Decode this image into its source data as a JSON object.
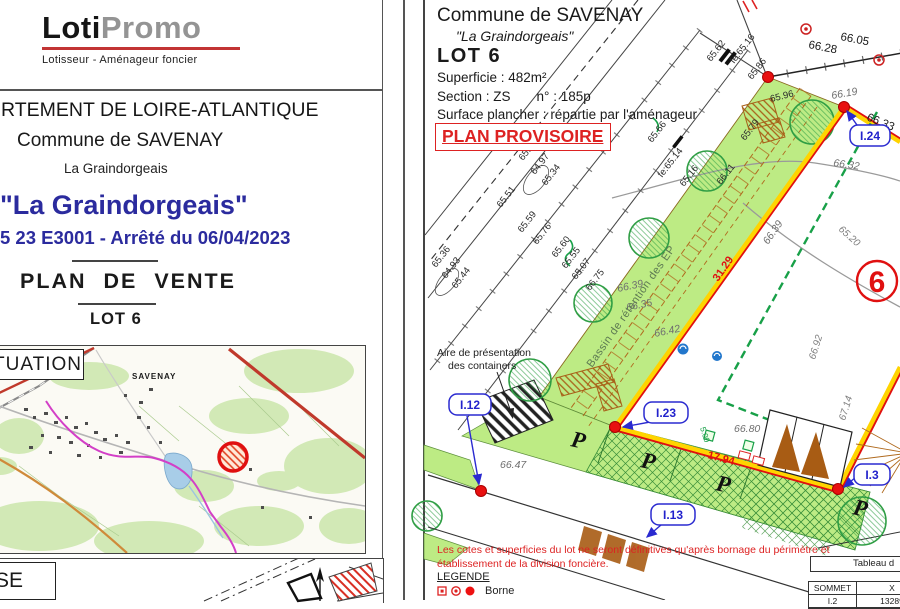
{
  "left_page": {
    "logo_part1": "Loti",
    "logo_part2": "Promo",
    "logo_tagline": "Lotisseur - Aménageur foncier",
    "department": "RTEMENT DE LOIRE-ATLANTIQUE",
    "commune": "Commune de SAVENAY",
    "lieu": "La Graindorgeais",
    "title": "\"La Graindorgeais\"",
    "dossier": "5 23 E3001 - Arrêté du 06/04/2023",
    "plan_type": "PLAN  DE  VENTE",
    "lot": "LOT 6",
    "situation_panel_label": "TUATION",
    "masse_panel_label": "SE",
    "map": {
      "town": "SAVENAY"
    }
  },
  "right_page": {
    "commune": "Commune de SAVENAY",
    "lieu": "\"La Graindorgeais\"",
    "lot_title": "LOT 6",
    "superficie": "Superficie :  482m²",
    "section_label": "Section :  ZS",
    "numero_label": "n° :  185p",
    "surface_plancher": "Surface plancher : répartie par l'aménageur",
    "plan_provisoire": "PLAN PROVISOIRE",
    "lot_number": "6",
    "bassin": "Bassin de rétention des EP",
    "containers_line1": "Aire de présentation",
    "containers_line2": "des containers",
    "parking_letter": "P",
    "points": {
      "i24": "I.24",
      "i23": "I.23",
      "i12": "I.12",
      "i13": "I.13",
      "i3": "I.3"
    },
    "dims": {
      "d31": "31.29",
      "d17": "17.94",
      "d5": "5.00"
    },
    "elev": [
      "65.62",
      "fe:65.16",
      "65.86",
      "65.96",
      "65.79",
      "65.66",
      "fe:65.14",
      "65.16",
      "66.11",
      "65.33",
      "64.97",
      "65.34",
      "65.51",
      "65.59",
      "65.76",
      "65.36",
      "64.93",
      "65.44",
      "65.60",
      "65.55",
      "65.07",
      "66.75"
    ],
    "topo": [
      "66.28",
      "66.05",
      "66.19",
      "66.33",
      "66.32",
      "65.20",
      "66.39",
      "66.39",
      "66.35",
      "66.42",
      "66.92",
      "67.14",
      "66.80",
      "66.47"
    ],
    "note_line1": "Les cotes et superficies du lot ne seront définitives qu'après bornage du périmètre et",
    "note_line2": "établissement de la division foncière.",
    "legend_title": "LEGENDE",
    "legend_borne": "Borne",
    "table": {
      "title": "Tableau d",
      "col_sommet": "SOMMET",
      "col_x": "X",
      "row_sommet": "I.2",
      "row_x": "13289"
    }
  },
  "colors": {
    "title_blue": "#2b2b9e",
    "alert_red": "#dd2222",
    "parcel_green": "#bdeb84",
    "boundary_yellow": "#ffd400",
    "boundary_red": "#e01010",
    "point_label_blue": "#2a2ad0",
    "dashed_limit_green": "#18a048"
  }
}
